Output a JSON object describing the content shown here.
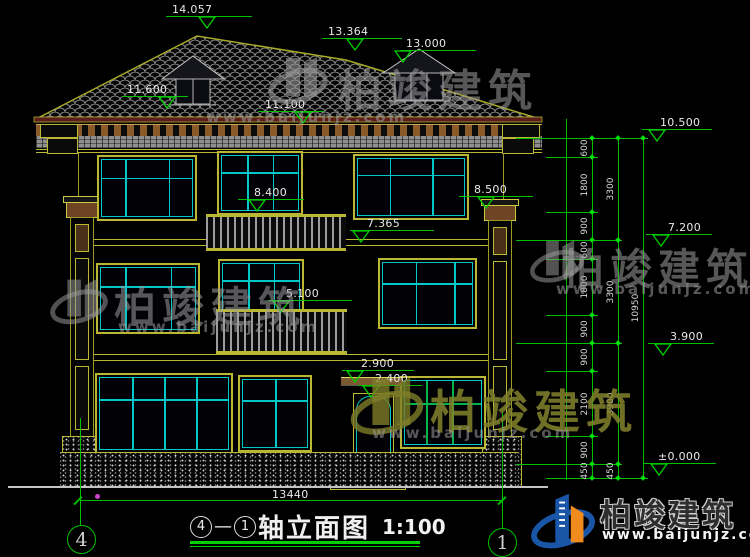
{
  "drawing": {
    "title": {
      "axis_from": "4",
      "dash": "—",
      "axis_to": "1",
      "text": "轴立面图",
      "scale": "1:100"
    },
    "bottom_dimension": "13440",
    "axes": {
      "left": "4",
      "right": "1"
    },
    "elevations": {
      "peak": "14.057",
      "secondary_ridge": "13.364",
      "dormer": "13.000",
      "roof_left": "11.600",
      "eave": "11.100",
      "third_balcony": "8.400",
      "third_floor": "7.365",
      "pilaster_top": "8.500",
      "second_balcony": "5.100",
      "canopy": "2.900",
      "door_head": "2.400",
      "right_top": "10.500",
      "right_third_floor": "7.200",
      "right_second_floor": "3.900",
      "right_ground": "±0.000"
    },
    "dim_chain": {
      "inner": [
        "600",
        "1800",
        "900",
        "600",
        "1800",
        "900",
        "900",
        "2100",
        "900",
        "450"
      ],
      "middle": [
        "3300",
        "3300",
        "3900",
        "450"
      ],
      "outer": [
        "10950"
      ]
    },
    "watermark": {
      "brand": "柏竣建筑",
      "url": "www.baijunjz.com"
    },
    "logo": {
      "brand": "柏竣建筑",
      "url": "www.baijunjz.com"
    },
    "colors": {
      "dimension_green": "#00bf00",
      "outline_yellow": "#b8b832",
      "frame_cyan": "#00c8c8",
      "tile_gray": "#8c8c8c",
      "logo_blue": "#1a56a8",
      "logo_orange": "#f08c1e"
    }
  }
}
